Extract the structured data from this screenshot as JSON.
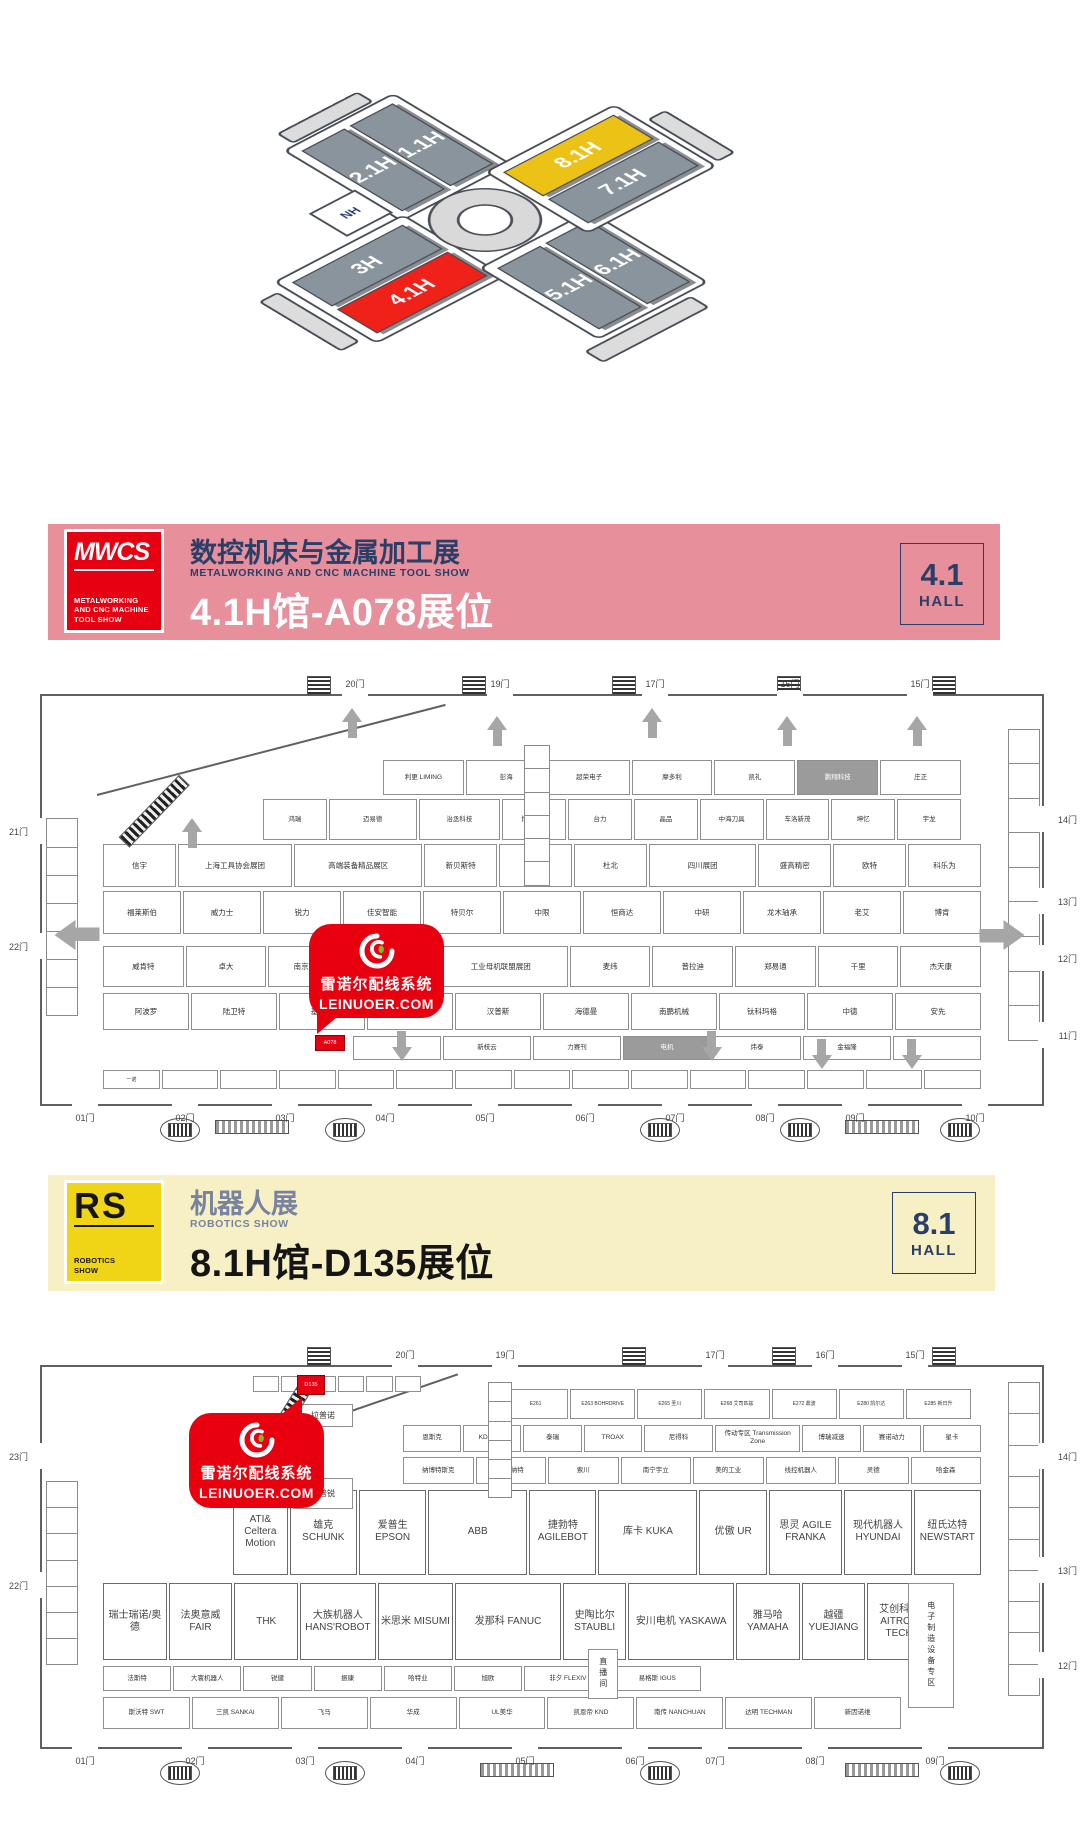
{
  "overview_map": {
    "halls": {
      "h3": "3H",
      "h41": "4.1H",
      "h21": "2.1H",
      "h11": "1.1H",
      "h81": "8.1H",
      "h71": "7.1H",
      "h51": "5.1H",
      "h61": "6.1H",
      "nh": "NH"
    },
    "colors": {
      "hall_gray": "#8a949c",
      "hall_red": "#f02119",
      "hall_yellow": "#ecc216",
      "outline": "#454b54"
    }
  },
  "banner_mwcs": {
    "bg": "#e78f9a",
    "logo": {
      "text": "MWCS",
      "tagline1": "METALWORKING",
      "tagline2": "AND CNC MACHINE",
      "tagline3": "TOOL SHOW",
      "bg": "#e60012"
    },
    "title": "数控机床与金属加工展",
    "subtitle": "METALWORKING AND CNC MACHINE TOOL SHOW",
    "booth_line": "4.1H馆-A078展位",
    "badge": {
      "number": "4.1",
      "word": "HALL",
      "color": "#2a3f68"
    }
  },
  "banner_rs": {
    "bg": "#f7f0c5",
    "logo": {
      "text": "RS",
      "tagline1": "ROBOTICS",
      "tagline2": "SHOW",
      "bg": "#f0d416"
    },
    "title": "机器人展",
    "subtitle": "ROBOTICS SHOW",
    "booth_line": "8.1H馆-D135展位",
    "badge": {
      "number": "8.1",
      "word": "HALL",
      "color": "#2a3f68"
    }
  },
  "stamp": {
    "line1": "雷诺尔配线系统",
    "line2": "LEINUOER.COM",
    "bg": "#e8000f",
    "accent_green": "#7fb927"
  },
  "hall41": {
    "rows": [
      {
        "box": [
          34,
          15.5,
          58,
          9
        ],
        "size": "s",
        "cells": [
          "利更 LIMING",
          "彭海",
          "超荣电子",
          "摩多利",
          "凯礼",
          {
            "t": "鹏翔科技",
            "g": 1
          },
          "庄正"
        ]
      },
      {
        "box": [
          22,
          25,
          70,
          10.5
        ],
        "size": "s",
        "cells": [
          "鸿瑞",
          {
            "t": "迈易德",
            "w": 1.4
          },
          {
            "t": "治丞科技",
            "w": 1.3
          },
          "博时培林",
          "台力",
          "晶品",
          "中海刀具",
          "车洛新茂",
          "坤忆",
          "宇龙"
        ]
      },
      {
        "box": [
          6,
          36,
          88,
          11
        ],
        "size": "m",
        "cells": [
          "信宇",
          {
            "t": "上海工具协会展团",
            "w": 1.6
          },
          {
            "t": "高端装备精品展区",
            "w": 1.8
          },
          "新贝斯特",
          "桔锐",
          "杜北",
          {
            "t": "四川展团",
            "w": 1.5
          },
          "盛高精密",
          "欧特",
          "科乐为"
        ]
      },
      {
        "box": [
          6,
          47.5,
          88,
          11
        ],
        "size": "m",
        "cells": [
          "福莱斯伯",
          "威力士",
          "锐力",
          "佳安智能",
          "特贝尔",
          "中限",
          "恒商达",
          "中研",
          "龙木轴承",
          "老艾",
          "博肯"
        ]
      },
      {
        "box": [
          6,
          61,
          88,
          10.5
        ],
        "size": "m",
        "cells": [
          "威肯特",
          "卓大",
          "南京工艺",
          "萨科朗德",
          {
            "t": "工业母机联盟展团",
            "w": 1.7
          },
          "麦纬",
          "普拉迪",
          "郑易通",
          "千里",
          "杰天康"
        ]
      },
      {
        "box": [
          6,
          72.5,
          88,
          9.5
        ],
        "size": "m",
        "cells": [
          "阿波罗",
          "陆卫特",
          "基恩士",
          "台稳",
          "汉普斯",
          "海德曼",
          "南鹏机械",
          "钛科玛格",
          "中德",
          "安先"
        ]
      },
      {
        "box": [
          31,
          83,
          63,
          6.5
        ],
        "size": "s",
        "cells": [
          "",
          "新枝云",
          "力赛刊",
          {
            "t": "电机",
            "g": 1
          },
          "炜泰",
          "金福隆",
          ""
        ]
      },
      {
        "box": [
          6,
          91.5,
          88,
          5
        ],
        "size": "t",
        "cells": [
          "一诺",
          "",
          "",
          "",
          "",
          "",
          "",
          "",
          "",
          "",
          "",
          "",
          "",
          "",
          ""
        ]
      }
    ],
    "doors": {
      "top": [
        [
          30,
          "20门"
        ],
        [
          44.5,
          "19门"
        ],
        [
          60,
          "17门"
        ],
        [
          73.5,
          "16门"
        ],
        [
          86.5,
          "15门"
        ]
      ],
      "right": [
        [
          27,
          "14门"
        ],
        [
          47,
          "13门"
        ],
        [
          61,
          "12门"
        ],
        [
          80,
          "11门"
        ]
      ],
      "bottom": [
        [
          3,
          "01门"
        ],
        [
          13,
          "02门"
        ],
        [
          23,
          "03门"
        ],
        [
          33,
          "04门"
        ],
        [
          43,
          "05门"
        ],
        [
          53,
          "06门"
        ],
        [
          62,
          "07门"
        ],
        [
          71,
          "08门"
        ],
        [
          80,
          "09门"
        ],
        [
          92,
          "10门"
        ]
      ],
      "left": [
        [
          30,
          "21门"
        ],
        [
          58,
          "22门"
        ]
      ]
    },
    "arrows": [
      {
        "dir": "up",
        "x": 30,
        "y": 3
      },
      {
        "dir": "up",
        "x": 44.5,
        "y": 5
      },
      {
        "dir": "up",
        "x": 60,
        "y": 3
      },
      {
        "dir": "up",
        "x": 73.5,
        "y": 5
      },
      {
        "dir": "up",
        "x": 86.5,
        "y": 5
      },
      {
        "dir": "up",
        "x": 14,
        "y": 30
      },
      {
        "dir": "left",
        "x": 2.5,
        "y": 55,
        "big": 1
      },
      {
        "dir": "right",
        "x": 95,
        "y": 55,
        "big": 1
      },
      {
        "dir": "down",
        "x": 35,
        "y": 82
      },
      {
        "dir": "down",
        "x": 66,
        "y": 82
      },
      {
        "dir": "down",
        "x": 77,
        "y": 84
      },
      {
        "dir": "down",
        "x": 86,
        "y": 84
      }
    ],
    "strips": [
      {
        "box": [
          0.4,
          30,
          3,
          48
        ],
        "n": 7
      },
      {
        "box": [
          96.6,
          8,
          3,
          76
        ],
        "n": 9
      },
      {
        "box": [
          48.2,
          12,
          2.4,
          34
        ],
        "n": 6
      }
    ],
    "extras": [],
    "highlight": {
      "t": "A078",
      "box": [
        27.3,
        83,
        2.8,
        3.6
      ]
    },
    "top_escalators": [
      26.5,
      42,
      57,
      73.5,
      89
    ],
    "diagonal": [
      5.5,
      24,
      36,
      -14.5
    ],
    "ramp": [
      8.2,
      34,
      8.5,
      -46
    ]
  },
  "hall81": {
    "rows": [
      {
        "box": [
          21,
          2,
          17,
          4.8
        ],
        "size": "t",
        "cells": [
          "",
          "",
          "",
          "",
          "",
          ""
        ]
      },
      {
        "box": [
          46,
          5.5,
          47,
          8.5
        ],
        "size": "t",
        "cells": [
          "E261",
          "E263 BOHRDRIVE",
          "E265 圣川",
          "E268 艾司匹兹",
          "E272 鼎波",
          "E280 凯尔达",
          "E285 新日升"
        ]
      },
      {
        "box": [
          36,
          15,
          58,
          7.5
        ],
        "size": "s",
        "cells": [
          "恩斯克",
          "KD&MBK",
          "泰瑞",
          "TROAX",
          {
            "t": "尼得科",
            "w": 1.2
          },
          {
            "t": "传动专区 Transmission Zone",
            "w": 1.5
          },
          "博瑞减速",
          "赛诺动力",
          "星卡"
        ]
      },
      {
        "box": [
          36,
          23.5,
          58,
          7.5
        ],
        "size": "s",
        "cells": [
          "纳博特斯克",
          "姬勃纳特",
          "索川",
          "南宁宇立",
          "美的工业",
          "线控机器人",
          "灵德",
          "哈金森"
        ]
      },
      {
        "box": [
          19,
          32,
          75,
          23
        ],
        "size": "l",
        "cells": [
          {
            "t": "ATI& Celtera Motion",
            "w": 0.8
          },
          "雄克 SCHUNK",
          "爱普生 EPSON",
          {
            "t": "ABB",
            "w": 1.5
          },
          "捷勃特 AGILEBOT",
          {
            "t": "库卡 KUKA",
            "w": 1.5
          },
          "优傲 UR",
          {
            "t": "思灵 AGILE FRANKA",
            "w": 1.1
          },
          "现代机器人 HYUNDAI",
          "纽氏达特 NEWSTART"
        ]
      },
      {
        "box": [
          6,
          56.5,
          83,
          21
        ],
        "size": "l",
        "cells": [
          "瑞士瑞诺/奥德",
          "法奥意威 FAIR",
          "THK",
          {
            "t": "大族机器人 HANS'ROBOT",
            "w": 1.2
          },
          {
            "t": "米思米 MISUMI",
            "w": 1.2
          },
          {
            "t": "发那科 FANUC",
            "w": 1.7
          },
          "史陶比尔 STAUBLI",
          {
            "t": "安川电机 YASKAWA",
            "w": 1.7
          },
          "雅马哈 YAMAHA",
          "越疆 YUEJIANG",
          "艾创科技 AITRON TECH"
        ]
      },
      {
        "box": [
          6,
          78.5,
          60,
          7
        ],
        "size": "s",
        "cells": [
          "法斯特",
          "大寰机器人",
          "锐健",
          "振康",
          "哈特业",
          "旭欧",
          {
            "t": "非夕 FLEXIV",
            "w": 1.3
          },
          {
            "t": "易格斯 IGUS",
            "w": 1.3
          }
        ]
      },
      {
        "box": [
          6,
          86.5,
          80,
          9
        ],
        "size": "s",
        "cells": [
          "斯沃特 SWT",
          "三凯 SANKAI",
          "飞马",
          "华成",
          "UL美华",
          "凯恩帝 KND",
          "南传 NANCHUAN",
          "达明 TECHMAN",
          "新因诺维"
        ]
      }
    ],
    "doors": {
      "top": [
        [
          35,
          "20门"
        ],
        [
          45,
          "19门"
        ],
        [
          66,
          "17门"
        ],
        [
          77,
          "16门"
        ],
        [
          86,
          "15门"
        ]
      ],
      "right": [
        [
          20,
          "14门"
        ],
        [
          50,
          "13门"
        ],
        [
          75,
          "12门"
        ]
      ],
      "bottom": [
        [
          3,
          "01门"
        ],
        [
          14,
          "02门"
        ],
        [
          25,
          "03门"
        ],
        [
          36,
          "04门"
        ],
        [
          47,
          "05门"
        ],
        [
          58,
          "06门"
        ],
        [
          66,
          "07门"
        ],
        [
          76,
          "08门"
        ],
        [
          88,
          "09门"
        ]
      ],
      "left": [
        [
          20,
          "23门"
        ],
        [
          54,
          "22门"
        ]
      ]
    },
    "arrows": [],
    "strips": [
      {
        "box": [
          0.4,
          30,
          3,
          48
        ],
        "n": 7
      },
      {
        "box": [
          96.6,
          4,
          3,
          82
        ],
        "n": 10
      },
      {
        "box": [
          44.6,
          4,
          2.2,
          30
        ],
        "n": 6
      }
    ],
    "extras": [
      {
        "t": "拉普诺",
        "box": [
          25,
          9.5,
          6,
          6
        ]
      },
      {
        "t": "海普锐",
        "box": [
          25,
          29,
          6,
          8
        ]
      },
      {
        "t": "电子制造设备专区",
        "box": [
          86.5,
          56.5,
          4.6,
          33
        ],
        "v": 1
      },
      {
        "t": "直播间",
        "box": [
          54.5,
          74,
          3,
          13
        ],
        "v": 1
      }
    ],
    "highlight": {
      "t": "D135",
      "box": [
        25.5,
        2,
        2.6,
        4.8
      ]
    },
    "top_escalators": [
      26.5,
      58,
      73,
      89
    ],
    "diagonal": [
      17,
      24,
      26,
      -19
    ],
    "ramp": [
      20.5,
      28,
      10.5,
      -58
    ]
  },
  "apron41": {
    "ovals": [
      12,
      28.5,
      60,
      74,
      90
    ],
    "bars": [
      17.5,
      80.5
    ]
  },
  "apron81": {
    "ovals": [
      12,
      28.5,
      60,
      90
    ],
    "bars": [
      44,
      80.5
    ]
  }
}
